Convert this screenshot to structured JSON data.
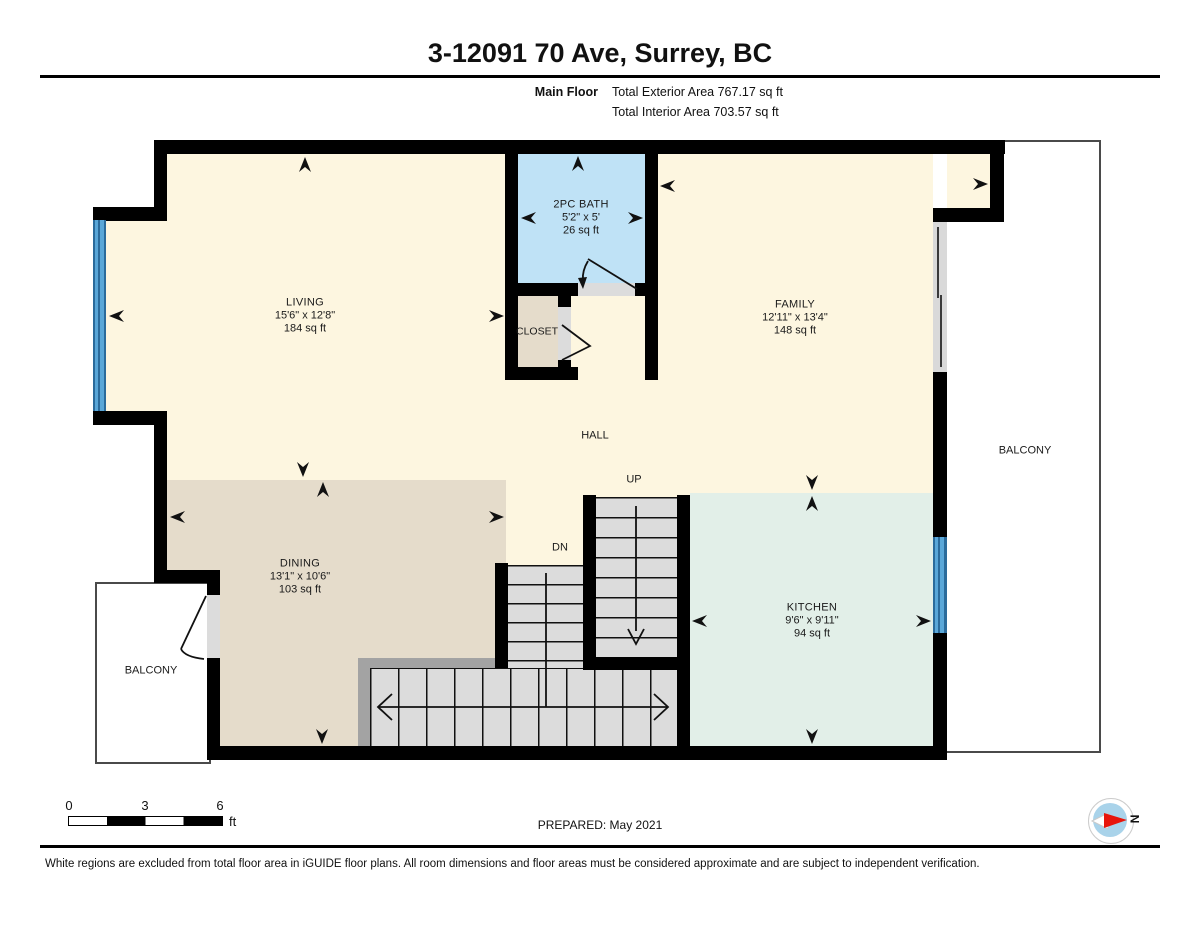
{
  "header": {
    "title": "3-12091 70 Ave, Surrey, BC",
    "floor_label": "Main Floor",
    "total_exterior": "Total Exterior Area 767.17 sq ft",
    "total_interior": "Total Interior Area 703.57 sq ft"
  },
  "rooms": {
    "living": {
      "name": "LIVING",
      "dims": "15'6\" x 12'8\"",
      "area": "184 sq ft"
    },
    "bath": {
      "name": "2PC BATH",
      "dims": "5'2\" x 5'",
      "area": "26 sq ft"
    },
    "family": {
      "name": "FAMILY",
      "dims": "12'11\" x 13'4\"",
      "area": "148 sq ft"
    },
    "dining": {
      "name": "DINING",
      "dims": "13'1\" x 10'6\"",
      "area": "103 sq ft"
    },
    "kitchen": {
      "name": "KITCHEN",
      "dims": "9'6\" x 9'11\"",
      "area": "94 sq ft"
    },
    "closet": {
      "name": "CLOSET"
    },
    "hall": {
      "name": "HALL"
    },
    "balcony_right": {
      "name": "BALCONY"
    },
    "balcony_left": {
      "name": "BALCONY"
    }
  },
  "stairs": {
    "up_label": "UP",
    "down_label": "DN"
  },
  "scale_bar": {
    "tick_0": "0",
    "tick_3": "3",
    "tick_6": "6",
    "unit": "ft"
  },
  "compass": {
    "north_label": "N"
  },
  "footer": {
    "prepared": "PREPARED: May 2021",
    "disclaimer": "White regions are excluded from total floor area in iGUIDE floor plans. All room dimensions and floor areas must be considered approximate and are subject to independent verification."
  },
  "colors": {
    "wall": "#000000",
    "room_cream": "#fdf6e0",
    "room_dining": "#e5dccb",
    "room_bath": "#bfe2f6",
    "room_kitchen": "#e2efe8",
    "stair_tread": "#dcdcdc",
    "window_blue": "#5aa7d8",
    "railing_gray": "#a3a3a3",
    "balcony_white": "#ffffff",
    "compass_red": "#e8150b",
    "compass_blue": "#a9d3ea"
  }
}
